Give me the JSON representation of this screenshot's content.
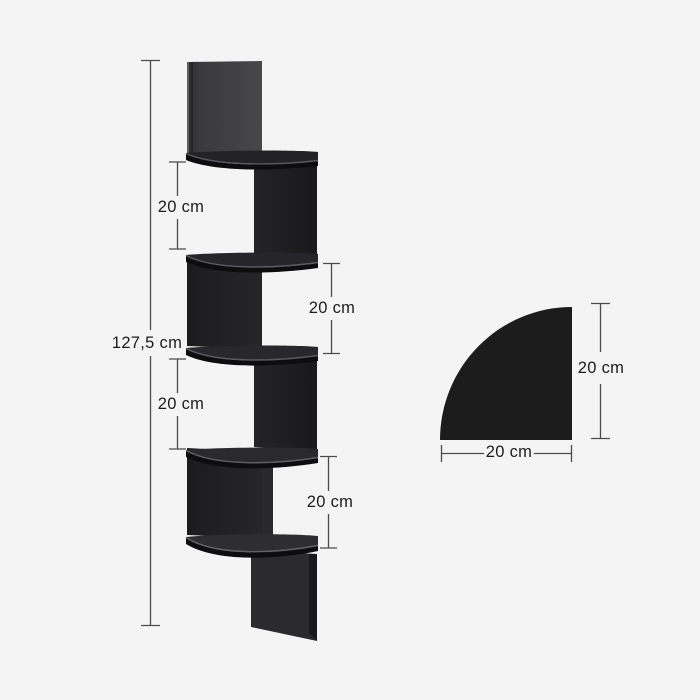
{
  "front_view": {
    "total_height_label": "127,5 cm",
    "gap_labels": [
      "20 cm",
      "20 cm",
      "20 cm",
      "20 cm"
    ]
  },
  "top_view": {
    "depth_label": "20 cm",
    "width_label": "20 cm"
  },
  "colors": {
    "shelf_black": "#1c1c1d",
    "panel_dark": "#1d1d20",
    "panel_mid": "#212124",
    "dimension_line": "#4b4b4b",
    "text": "#1c1c1c",
    "background": "#f4f4f5"
  }
}
